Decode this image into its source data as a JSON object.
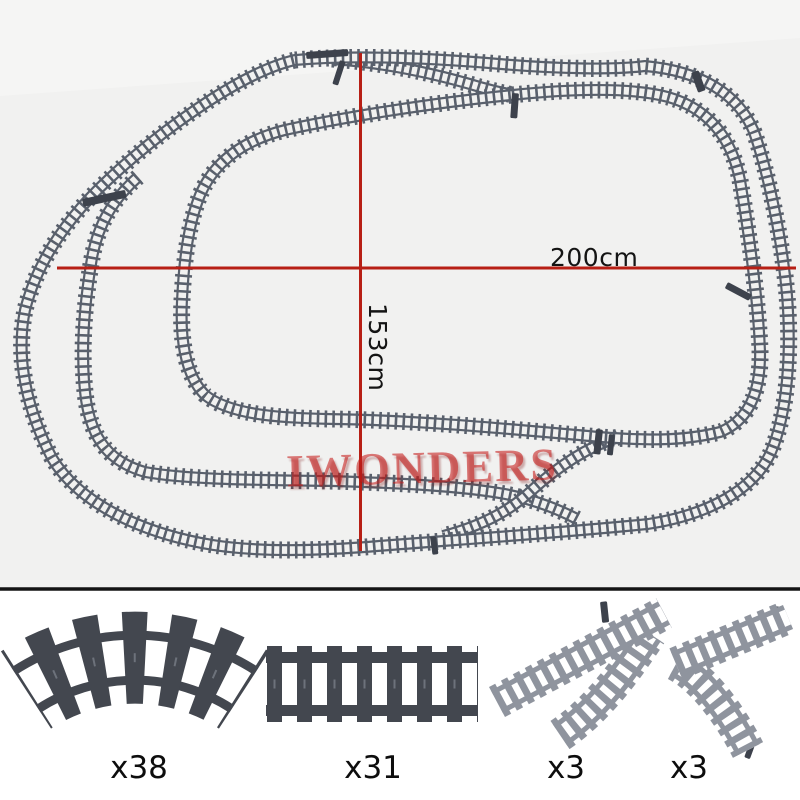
{
  "diagram": {
    "width_label": "200cm",
    "height_label": "153cm",
    "watermark": "IWONDERS"
  },
  "parts": [
    {
      "id": "curved-track",
      "count": "x38"
    },
    {
      "id": "straight-track",
      "count": "x31"
    },
    {
      "id": "switch-track-left",
      "count": "x3"
    },
    {
      "id": "switch-track-right",
      "count": "x3"
    }
  ],
  "colors": {
    "top_background": "#f1f1f0",
    "bottom_background": "#ffffff",
    "dimension_line": "#b71f15",
    "layout_track": "#59606c",
    "piece_dark": "#43474f",
    "piece_stud": "#6d727b",
    "piece_light": "#8f949e",
    "lever": "#3d424c",
    "divider": "#141414",
    "label_text": "#0d0d0d"
  }
}
